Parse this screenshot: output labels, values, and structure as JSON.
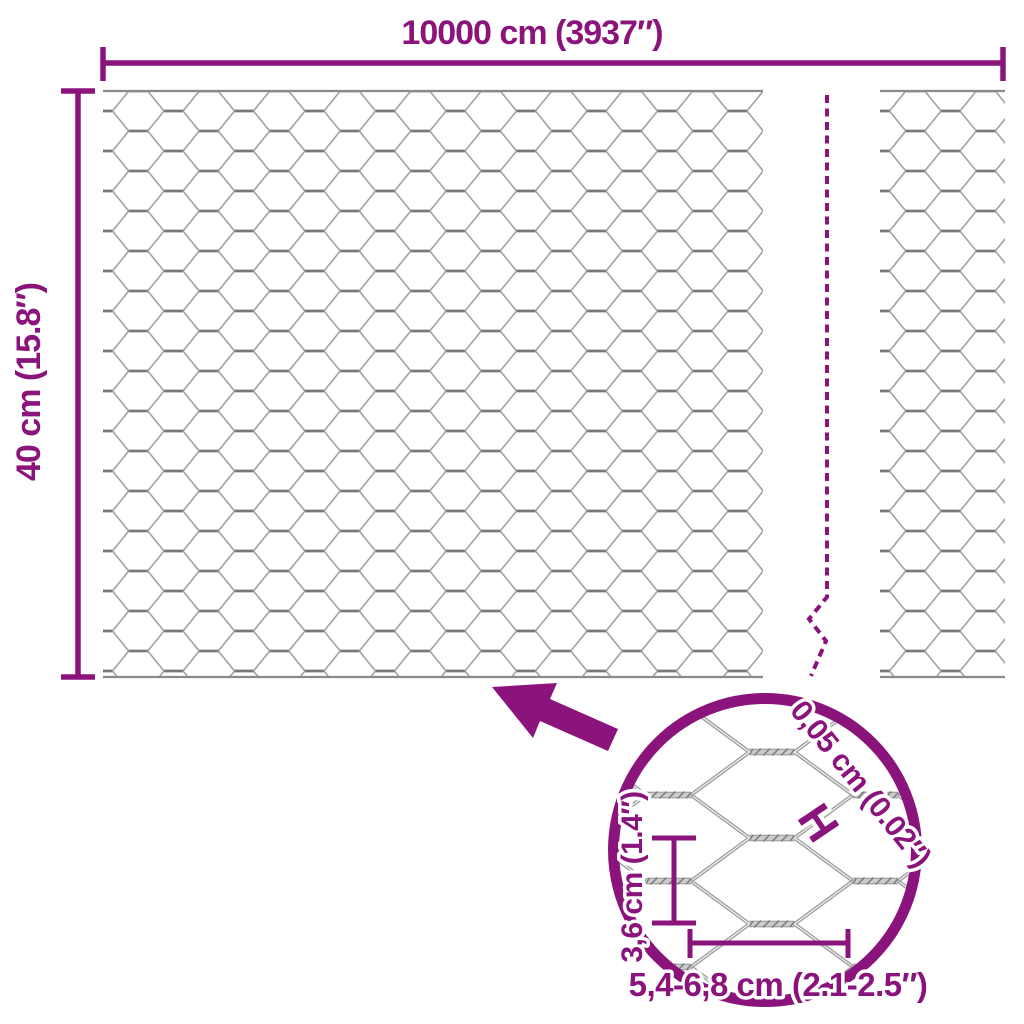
{
  "diagram": {
    "title": "hexagonal wire mesh roll dimensions",
    "width_dimension": {
      "label": "10000 cm (3937″)"
    },
    "height_dimension": {
      "label": "40 cm (15.8″)"
    },
    "detail": {
      "wire_thickness": {
        "label": "0,05 cm (0.02″)",
        "marker": "H"
      },
      "mesh_height": {
        "label": "3,6 cm (1.4″)"
      },
      "mesh_opening_width": {
        "label": "5,4-6,8 cm (2.1-2.5″)"
      }
    },
    "colors": {
      "accent": "#8B147C",
      "wire": "#9c9c9c",
      "wire_dark": "#787878"
    }
  }
}
